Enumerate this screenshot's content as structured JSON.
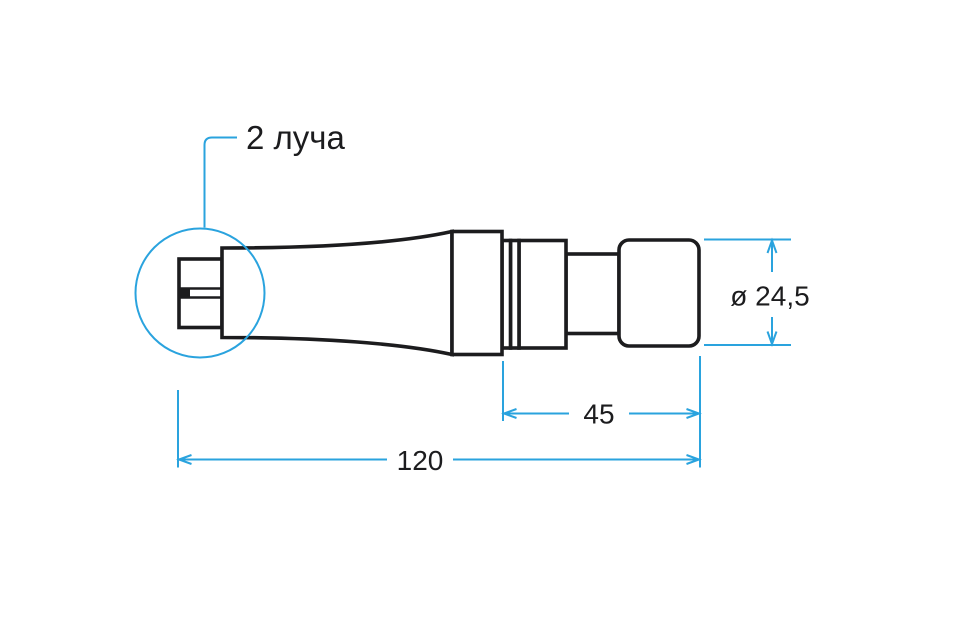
{
  "colors": {
    "accent": "#2AA3DE",
    "ink": "#1C1C1E",
    "background": "#FFFFFF"
  },
  "drawing": {
    "callout": {
      "label": "2 луча"
    },
    "dimensions": [
      {
        "name": "diameter",
        "label": "ø 24,5"
      },
      {
        "name": "front-section-length",
        "label": "45"
      },
      {
        "name": "overall-length",
        "label": "120"
      }
    ]
  }
}
